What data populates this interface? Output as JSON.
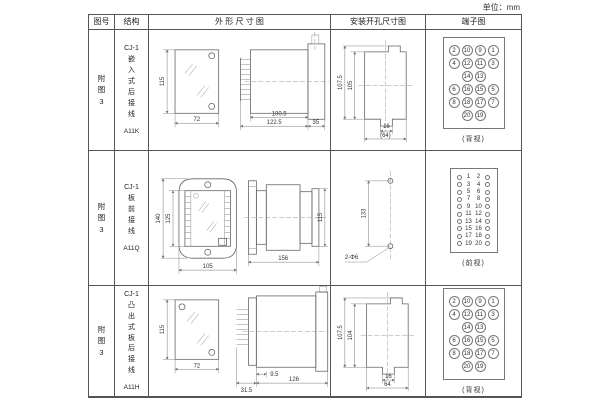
{
  "unit_label": "单位：mm",
  "header": {
    "fig_no": "图号",
    "structure": "结构",
    "outline": "外 形 尺 寸 图",
    "install": "安装开孔尺寸图",
    "terminal": "端子图"
  },
  "rows": [
    {
      "fig_no": "附图3",
      "structure": {
        "series": "CJ-1",
        "desc": "嵌入式后接线",
        "code": "A11K"
      },
      "outline": {
        "front_h": "115",
        "front_w": "72",
        "d1": "100.5",
        "d2": "122.5",
        "d3": "35"
      },
      "install": {
        "v1": "107.5",
        "v2": "105",
        "h1": "16",
        "h2": "(64)"
      },
      "terminal": {
        "caption": "(背视)",
        "grid": [
          "2",
          "10",
          "9",
          "1",
          "4",
          "12",
          "11",
          "3",
          "",
          "14",
          "13",
          "",
          "6",
          "16",
          "15",
          "5",
          "8",
          "18",
          "17",
          "7",
          "",
          "20",
          "19",
          ""
        ]
      }
    },
    {
      "fig_no": "附图3",
      "structure": {
        "series": "CJ-1",
        "desc": "板前接线",
        "code": "A11Q"
      },
      "outline": {
        "front_h1": "140",
        "front_h2": "125",
        "front_w": "105",
        "d1": "156",
        "d2": "115"
      },
      "install": {
        "v1": "133",
        "hole_label": "2-Φ6"
      },
      "terminal": {
        "caption": "(前视)",
        "pairs": [
          {
            "l": "1",
            "r": "2"
          },
          {
            "l": "3",
            "r": "4"
          },
          {
            "l": "5",
            "r": "6"
          },
          {
            "l": "7",
            "r": "8"
          },
          {
            "l": "9",
            "r": "10"
          },
          {
            "l": "11",
            "r": "12"
          },
          {
            "l": "13",
            "r": "14"
          },
          {
            "l": "15",
            "r": "16"
          },
          {
            "l": "17",
            "r": "18"
          },
          {
            "l": "19",
            "r": "20"
          }
        ]
      }
    },
    {
      "fig_no": "附图3",
      "structure": {
        "series": "CJ-1",
        "desc": "凸出式板后接线",
        "code": "A11H"
      },
      "outline": {
        "front_h": "115",
        "front_w": "72",
        "d1": "31.5",
        "d2": "9.5",
        "d3": "126"
      },
      "install": {
        "v1": "107.5",
        "v2": "104",
        "h1": "16",
        "h2": "64"
      },
      "terminal": {
        "caption": "(背视)",
        "grid": [
          "2",
          "10",
          "9",
          "1",
          "4",
          "12",
          "11",
          "3",
          "",
          "14",
          "13",
          "",
          "6",
          "16",
          "15",
          "5",
          "8",
          "18",
          "17",
          "7",
          "",
          "20",
          "19",
          ""
        ]
      }
    }
  ]
}
